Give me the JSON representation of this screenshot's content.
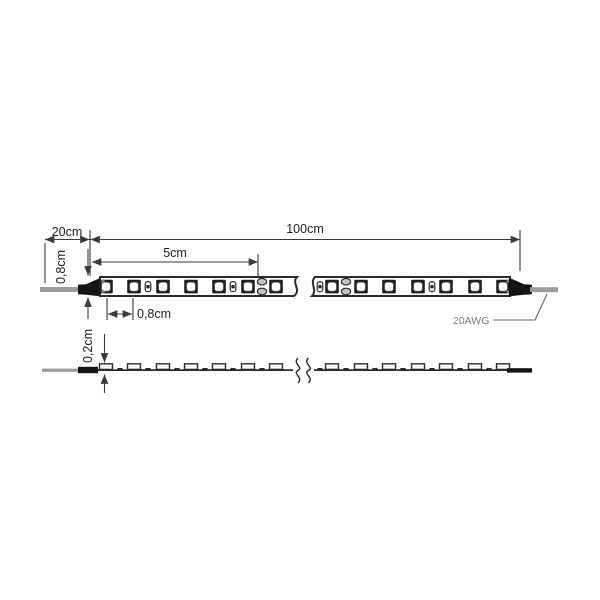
{
  "diagram": {
    "title": "led-strip-dimension-drawing",
    "labels": {
      "connector_length": "20cm",
      "strip_length": "100cm",
      "cut_segment": "5cm",
      "strip_width": "0,8cm",
      "led_pitch": "0,8cm",
      "strip_thickness": "0,2cm",
      "wire_gauge": "20AWG"
    },
    "colors": {
      "line": "#2b2b2b",
      "dim": "#3a3a3a",
      "text": "#1f1f1f",
      "wire": "#9c9c9c",
      "connector": "#141414",
      "led_body": "#1f1f1f",
      "led_chip": "#ffffff",
      "pad_fill": "#c4c4c4",
      "wire_label": "#7a7a7a",
      "background": "#ffffff"
    },
    "top_view": {
      "led_centers_left": [
        106,
        134,
        163,
        191,
        219,
        248,
        276
      ],
      "led_centers_right": [
        332,
        361,
        389,
        418,
        446,
        475,
        503
      ],
      "resistor_centers": [
        148,
        233,
        320,
        432
      ],
      "pad_centers": [
        262,
        346
      ],
      "end_pad_xs": [
        103,
        508
      ]
    },
    "side_view": {
      "bump_centers_left": [
        106,
        134,
        163,
        191,
        219,
        248,
        276
      ],
      "bump_centers_right": [
        332,
        361,
        389,
        418,
        446,
        475,
        503
      ],
      "dash_centers_left": [
        120,
        148,
        177,
        205,
        233,
        262
      ],
      "dash_centers_right": [
        320,
        346,
        375,
        403,
        432,
        460,
        489
      ]
    }
  }
}
